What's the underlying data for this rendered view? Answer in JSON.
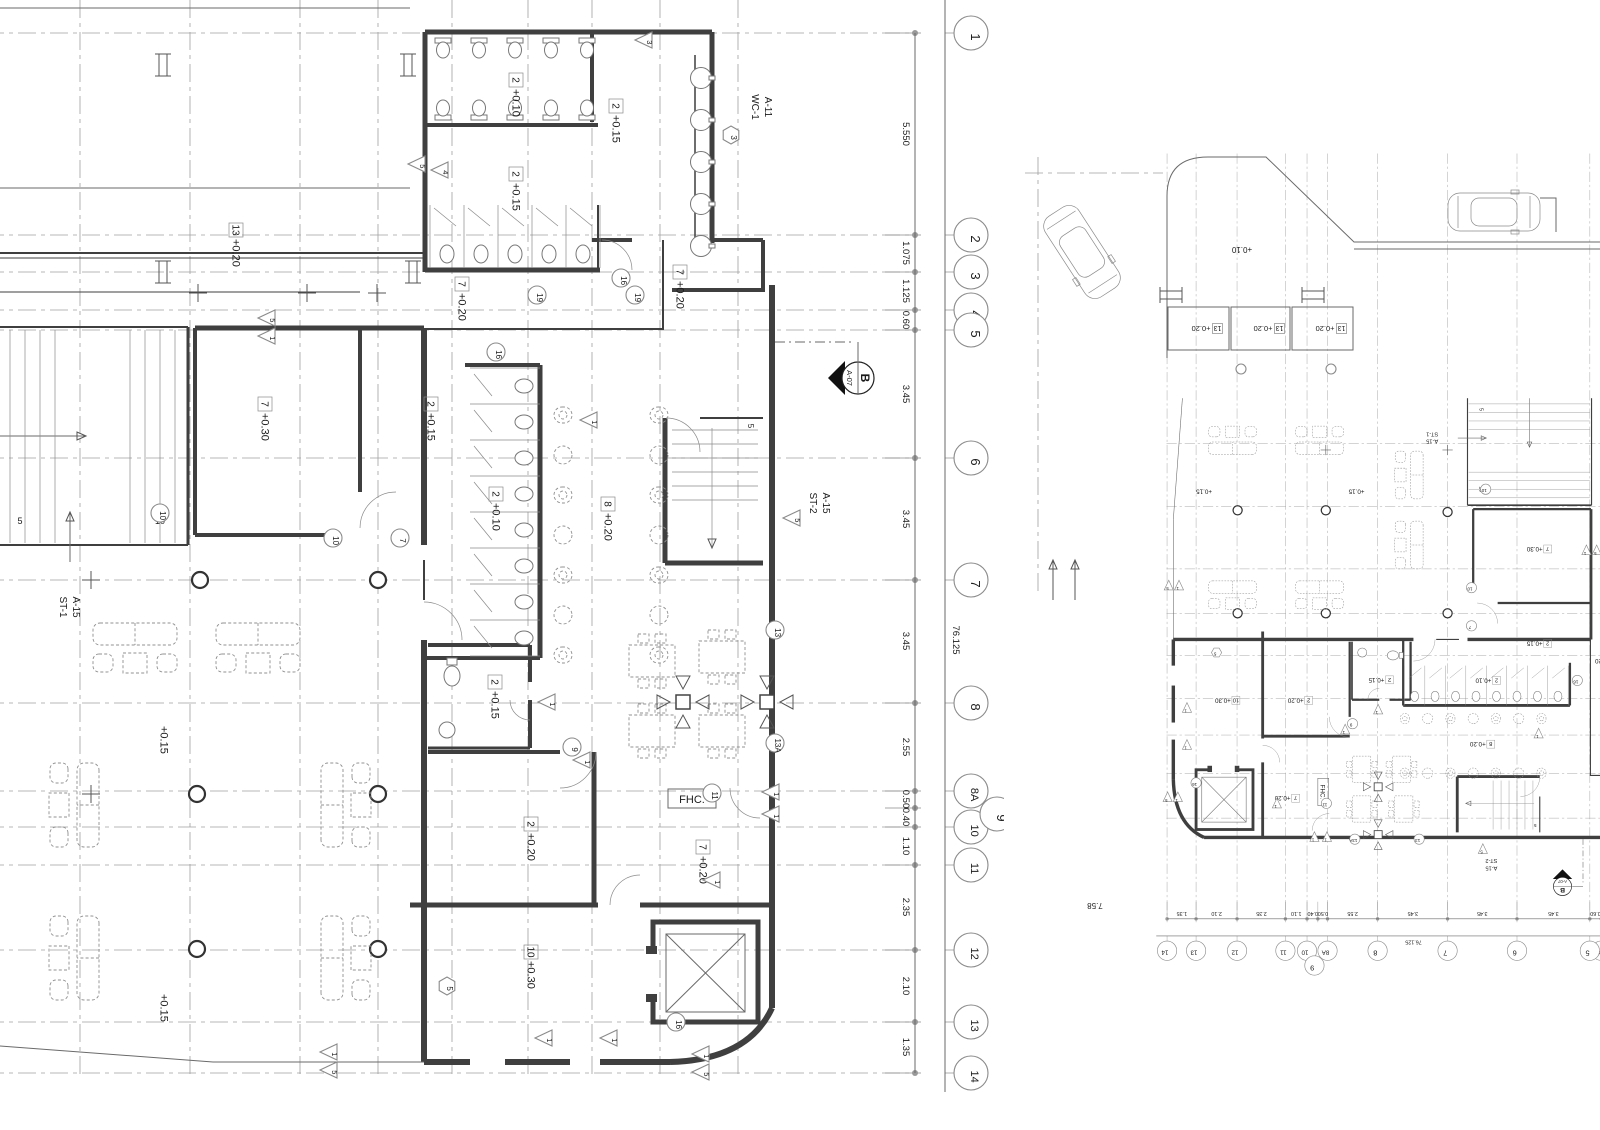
{
  "colors": {
    "wall": "#3f3f3f",
    "thin": "#6a6a6a",
    "grid": "#a0a0a0",
    "furniture": "#909090",
    "text": "#1b1b1b"
  },
  "plan": {
    "rows": [
      {
        "n": "1",
        "y": 33
      },
      {
        "n": "2",
        "y": 235
      },
      {
        "n": "3",
        "y": 272
      },
      {
        "n": "4",
        "y": 310
      },
      {
        "n": "5",
        "y": 330
      },
      {
        "n": "6",
        "y": 458
      },
      {
        "n": "7",
        "y": 580
      },
      {
        "n": "8",
        "y": 703
      },
      {
        "n": "8A",
        "y": 791
      },
      {
        "n": "10",
        "y": 827
      },
      {
        "n": "11",
        "y": 865
      },
      {
        "n": "12",
        "y": 950
      },
      {
        "n": "13",
        "y": 1022
      },
      {
        "n": "14",
        "y": 1073
      }
    ],
    "row9": {
      "n": "9",
      "x": 997,
      "y": 814,
      "tick": 808
    },
    "dims": [
      {
        "t": "5.550",
        "y": 134
      },
      {
        "t": "1.075",
        "y": 253
      },
      {
        "t": "1.125",
        "y": 291
      },
      {
        "t": "0.60",
        "y": 320
      },
      {
        "t": "3.45",
        "y": 394
      },
      {
        "t": "3.45",
        "y": 519
      },
      {
        "t": "3.45",
        "y": 641
      },
      {
        "t": "2.55",
        "y": 747
      },
      {
        "t": "0.50",
        "y": 799
      },
      {
        "t": "0.40",
        "y": 817
      },
      {
        "t": "1.10",
        "y": 846
      },
      {
        "t": "2.35",
        "y": 907
      },
      {
        "t": "2.10",
        "y": 986
      },
      {
        "t": "1.35",
        "y": 1047
      }
    ],
    "overall": {
      "t": "76.125",
      "x": 953,
      "y": 640
    },
    "cols": [
      80,
      190,
      300,
      378,
      452,
      528,
      592,
      660,
      738
    ],
    "bubbleX": 971,
    "tickX": 915,
    "dimTx": 903,
    "dimline": [
      915,
      33,
      915,
      1073
    ],
    "outline": [
      945,
      0,
      945,
      1092
    ],
    "walls": [
      [
        425,
        32,
        712,
        32,
        5
      ],
      [
        425,
        32,
        425,
        272,
        5
      ],
      [
        425,
        125,
        598,
        125,
        4
      ],
      [
        425,
        270,
        600,
        270,
        5
      ],
      [
        592,
        32,
        592,
        122,
        4
      ],
      [
        598,
        205,
        598,
        270,
        2
      ],
      [
        712,
        32,
        712,
        243,
        5
      ],
      [
        695,
        55,
        695,
        240,
        1.5
      ],
      [
        592,
        240,
        632,
        240,
        4
      ],
      [
        663,
        240,
        663,
        330,
        2
      ],
      [
        712,
        240,
        763,
        240,
        4
      ],
      [
        763,
        240,
        763,
        292,
        4
      ],
      [
        672,
        290,
        763,
        290,
        4
      ],
      [
        0,
        253,
        425,
        253,
        2
      ],
      [
        0,
        258,
        425,
        258,
        1
      ],
      [
        0,
        292,
        360,
        292,
        1
      ],
      [
        195,
        328,
        424,
        328,
        5
      ],
      [
        424,
        328,
        424,
        545,
        6
      ],
      [
        424,
        560,
        424,
        600,
        2
      ],
      [
        424,
        640,
        424,
        1062,
        6
      ],
      [
        195,
        328,
        195,
        535,
        4
      ],
      [
        360,
        328,
        360,
        492,
        4
      ],
      [
        195,
        535,
        332,
        535,
        4
      ],
      [
        188,
        327,
        188,
        545,
        3
      ],
      [
        0,
        327,
        188,
        327,
        2
      ],
      [
        0,
        545,
        188,
        545,
        2
      ],
      [
        465,
        365,
        540,
        365,
        4
      ],
      [
        540,
        365,
        540,
        658,
        5
      ],
      [
        424,
        658,
        540,
        658,
        4
      ],
      [
        424,
        329,
        663,
        329,
        2
      ],
      [
        665,
        418,
        665,
        563,
        5
      ],
      [
        665,
        563,
        763,
        563,
        5
      ],
      [
        700,
        418,
        763,
        418,
        2
      ],
      [
        772,
        285,
        772,
        1008,
        6
      ],
      [
        428,
        645,
        530,
        645,
        4
      ],
      [
        530,
        645,
        530,
        682,
        4
      ],
      [
        530,
        700,
        530,
        748,
        4
      ],
      [
        428,
        748,
        530,
        748,
        3
      ],
      [
        428,
        752,
        560,
        752,
        4
      ],
      [
        594,
        752,
        594,
        905,
        5
      ],
      [
        410,
        905,
        598,
        905,
        5
      ],
      [
        640,
        905,
        772,
        905,
        5
      ],
      [
        424,
        1062,
        470,
        1062,
        6
      ],
      [
        505,
        1062,
        570,
        1062,
        6
      ],
      [
        600,
        1062,
        670,
        1062,
        6
      ]
    ],
    "corner": "M670,1062 Q748,1060 772,1008",
    "thin": [
      [
        0,
        8,
        410,
        8
      ],
      [
        0,
        188,
        410,
        188
      ],
      [
        0,
        436,
        86,
        436
      ],
      [
        70,
        562,
        70,
        512
      ],
      [
        213,
        1062,
        424,
        1062
      ],
      [
        0,
        1046,
        213,
        1062
      ],
      [
        858,
        342,
        858,
        361
      ]
    ],
    "dashLeader": [
      775,
      342,
      852,
      342
    ],
    "arcs": [
      [
        632,
        240,
        30,
        180,
        90
      ],
      [
        360,
        492,
        36,
        90,
        0
      ],
      [
        424,
        640,
        38,
        270,
        0
      ],
      [
        530,
        700,
        20,
        90,
        180
      ],
      [
        560,
        752,
        36,
        0,
        90
      ],
      [
        700,
        418,
        34,
        180,
        90
      ],
      [
        640,
        905,
        30,
        180,
        270
      ],
      [
        760,
        788,
        30,
        90,
        180
      ]
    ],
    "labels": [
      {
        "b": "2",
        "t": "+0.10",
        "x": 516,
        "y": 96
      },
      {
        "b": "2",
        "t": "+0.15",
        "x": 616,
        "y": 122
      },
      {
        "b": "2",
        "t": "+0.15",
        "x": 516,
        "y": 190
      },
      {
        "b": "7",
        "t": "+0.20",
        "x": 462,
        "y": 300
      },
      {
        "b": "7",
        "t": "+0.20",
        "x": 680,
        "y": 288
      },
      {
        "b": "13",
        "t": "+0.20",
        "x": 236,
        "y": 246
      },
      {
        "b": "7",
        "t": "+0.30",
        "x": 265,
        "y": 420
      },
      {
        "b": "2",
        "t": "+0.15",
        "x": 431,
        "y": 420
      },
      {
        "b": "2",
        "t": "+0.10",
        "x": 496,
        "y": 510
      },
      {
        "b": "8",
        "t": "+0.20",
        "x": 608,
        "y": 520
      },
      {
        "b": "2",
        "t": "+0.15",
        "x": 495,
        "y": 698
      },
      {
        "b": "2",
        "t": "+0.20",
        "x": 531,
        "y": 840
      },
      {
        "b": "7",
        "t": "+0.20",
        "x": 703,
        "y": 863
      },
      {
        "b": "10",
        "t": "+0.30",
        "x": 531,
        "y": 968
      },
      {
        "t": "+0.15",
        "x": 164,
        "y": 740
      },
      {
        "t": "+0.15",
        "x": 164,
        "y": 1008
      }
    ],
    "fhc": {
      "t": "FHC.",
      "x": 668,
      "y": 789,
      "w": 48,
      "h": 19
    },
    "knC": [
      [
        621,
        278,
        "16"
      ],
      [
        537,
        295,
        "19"
      ],
      [
        635,
        295,
        "19"
      ],
      [
        496,
        352,
        "16"
      ],
      [
        160,
        513,
        "10"
      ],
      [
        333,
        538,
        "10"
      ],
      [
        400,
        538,
        "7"
      ],
      [
        572,
        747,
        "9"
      ],
      [
        712,
        793,
        "11"
      ],
      [
        775,
        630,
        "13"
      ],
      [
        775,
        743,
        "13A"
      ],
      [
        676,
        1022,
        "16"
      ]
    ],
    "knH": [
      [
        731,
        135,
        "3"
      ],
      [
        447,
        986,
        "5"
      ]
    ],
    "knT": [
      [
        645,
        40,
        "3"
      ],
      [
        418,
        164,
        "5"
      ],
      [
        441,
        170,
        "4"
      ],
      [
        268,
        318,
        "5"
      ],
      [
        268,
        336,
        "1"
      ],
      [
        590,
        420,
        "1"
      ],
      [
        548,
        702,
        "1"
      ],
      [
        583,
        760,
        "1"
      ],
      [
        793,
        518,
        "5"
      ],
      [
        772,
        792,
        "1"
      ],
      [
        772,
        814,
        "1"
      ],
      [
        713,
        880,
        "1"
      ],
      [
        330,
        1052,
        "1"
      ],
      [
        330,
        1070,
        "5"
      ],
      [
        545,
        1038,
        "1"
      ],
      [
        610,
        1038,
        "1"
      ],
      [
        702,
        1054,
        "1"
      ],
      [
        702,
        1072,
        "5"
      ]
    ],
    "markers": {
      "section": {
        "x": 858,
        "y": 378,
        "t1": "B",
        "t2": "A-07"
      },
      "wc1": {
        "x": 752,
        "y": 107,
        "l": [
          "WC-1",
          "A-11"
        ]
      },
      "st1": {
        "x": 60,
        "y": 607,
        "l": [
          "ST-1",
          "A-15"
        ]
      },
      "st2": {
        "x": 810,
        "y": 503,
        "l": [
          "ST-2",
          "A-15"
        ]
      }
    },
    "stairL": {
      "g1": 10,
      "g2": 130,
      "n": 4,
      "step": 15,
      "y0": 330,
      "y1": 543,
      "n5": {
        "t": "5",
        "x": 20,
        "y": 524
      },
      "n10": {
        "t": "10",
        "x": 160,
        "y": 524
      }
    },
    "stairS": {
      "x0": 672,
      "x1": 758,
      "y0": 430,
      "n": 6,
      "step": 14,
      "arrow": [
        712,
        428,
        712,
        548
      ],
      "n5": {
        "t": "5",
        "x": 748,
        "y": 426
      }
    },
    "elev": {
      "x": 653,
      "y": 922,
      "w": 105,
      "h": 100
    },
    "urinals": {
      "xs": [
        443,
        479,
        515,
        551,
        587
      ],
      "rows": [
        {
          "wy": 38,
          "d": 1
        },
        {
          "wy": 120,
          "d": -1
        }
      ]
    },
    "stallsTop": {
      "x0": 430,
      "n": 5,
      "w": 34,
      "y0": 205,
      "y1": 268
    },
    "stallsCol": {
      "y0": 368,
      "n": 8,
      "h": 36,
      "x0": 470,
      "x1": 540
    },
    "basinsR": {
      "x": 701,
      "ys": [
        78,
        120,
        162,
        204,
        246
      ]
    },
    "furnCols": {
      "xs": [
        563,
        659
      ],
      "y0": 415,
      "n": 7,
      "step": 40
    },
    "sqTables": [
      [
        652,
        661
      ],
      [
        722,
        657
      ],
      [
        652,
        731
      ],
      [
        722,
        731
      ]
    ],
    "colSq": [
      [
        683,
        702
      ],
      [
        767,
        702
      ]
    ],
    "colCirc": [
      [
        200,
        580
      ],
      [
        378,
        580
      ],
      [
        197,
        794
      ],
      [
        378,
        794
      ],
      [
        197,
        949
      ],
      [
        378,
        949
      ]
    ],
    "crosses": [
      [
        198,
        293
      ],
      [
        307,
        293
      ],
      [
        377,
        293
      ],
      [
        91,
        580
      ],
      [
        91,
        794
      ]
    ],
    "ibeams": [
      [
        163,
        65
      ],
      [
        408,
        65
      ],
      [
        163,
        272
      ],
      [
        413,
        272
      ]
    ],
    "sofas": [
      [
        135,
        650,
        0
      ],
      [
        258,
        650,
        0
      ],
      [
        72,
        805,
        90
      ],
      [
        348,
        805,
        270
      ],
      [
        72,
        958,
        90
      ],
      [
        348,
        958,
        270
      ]
    ],
    "awc": {
      "toilet": [
        452,
        676
      ],
      "basin": [
        447,
        730
      ]
    }
  },
  "right": {
    "transform": {
      "tx": 1777.6,
      "ty": 398.2,
      "s": 0.569
    },
    "site": {
      "path": "M1167,358 L1167,196 Q1167,157 1208,157 L1266,157 L1354,242 L1600,242",
      "edge2": [
        1354,
        249,
        1600,
        249
      ],
      "bracket": "M1540,198 L1556,198 L1556,232",
      "dash1": [
        1025,
        173,
        1163,
        173
      ],
      "dash2": [
        1038,
        157,
        1038,
        592
      ]
    },
    "planters": {
      "items": [
        [
          1168,
          307,
          61,
          43
        ],
        [
          1231,
          307,
          59,
          43
        ],
        [
          1292,
          307,
          61,
          43
        ]
      ],
      "b": "13",
      "t": "+0.20"
    },
    "lvl": {
      "t": "+0.10",
      "x": 1242,
      "y": 247
    },
    "dim": {
      "t": "7.58",
      "x": 1095,
      "y": 903
    },
    "cars": [
      [
        1082,
        252,
        237,
        96,
        40
      ],
      [
        1494,
        212,
        180,
        92,
        38
      ]
    ],
    "ibeams": [
      [
        1171,
        295
      ],
      [
        1313,
        295
      ]
    ],
    "arrows": [
      [
        1053,
        600,
        1053,
        560
      ],
      [
        1075,
        600,
        1075,
        560
      ]
    ],
    "circles": [
      [
        1241,
        369
      ],
      [
        1331,
        369
      ]
    ]
  },
  "clips": {
    "left": [
      0,
      0,
      1004,
      1130
    ],
    "right": [
      1008,
      0,
      592,
      1130
    ]
  }
}
